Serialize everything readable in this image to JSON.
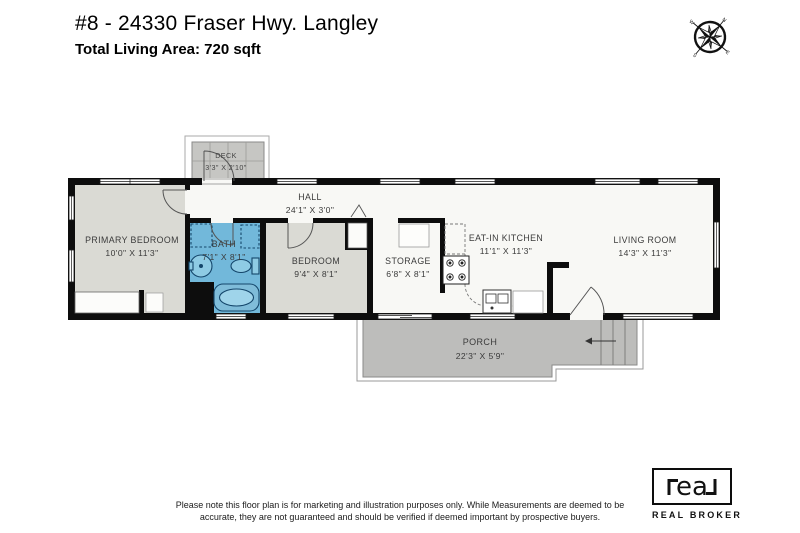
{
  "header": {
    "title": "#8 - 24330 Fraser Hwy. Langley",
    "subtitle": "Total Living Area: 720 sqft"
  },
  "compass": {
    "n": "N",
    "e": "E",
    "s": "S",
    "w": "W"
  },
  "rooms": [
    {
      "id": "primary_bedroom",
      "name": "PRIMARY BEDROOM",
      "dims": "10'0\" X 11'3\""
    },
    {
      "id": "bath",
      "name": "BATH",
      "dims": "7'1\" X 8'1\""
    },
    {
      "id": "bedroom",
      "name": "BEDROOM",
      "dims": "9'4\" X 8'1\""
    },
    {
      "id": "hall",
      "name": "HALL",
      "dims": "24'1\" X 3'0\""
    },
    {
      "id": "storage",
      "name": "STORAGE",
      "dims": "6'8\" X 8'1\""
    },
    {
      "id": "eat_in_kitchen",
      "name": "EAT-IN KITCHEN",
      "dims": "11'1\" X 11'3\""
    },
    {
      "id": "living_room",
      "name": "LIVING ROOM",
      "dims": "14'3\" X 11'3\""
    },
    {
      "id": "deck",
      "name": "DECK",
      "dims": "3'3\" X 2'10\""
    },
    {
      "id": "porch",
      "name": "PORCH",
      "dims": "22'3\" X 5'9\""
    }
  ],
  "footer": {
    "disclaimer": "Please note this floor plan is for marketing and illustration purposes only. While Measurements are deemed to be accurate, they are not guaranteed and should be verified if deemed important by prospective buyers."
  },
  "logo": {
    "wordmark": "real",
    "wordmark_letters": "ea",
    "name": "REAL BROKER"
  },
  "colors": {
    "wall": "#0d0d0d",
    "floor_white": "#f8f8f5",
    "room_gray": "#dadad4",
    "bath_blue": "#72b8da",
    "fixture_stroke": "#14466b",
    "porch_gray": "#bdbdbb",
    "deck_gray": "#c6c6c3"
  }
}
